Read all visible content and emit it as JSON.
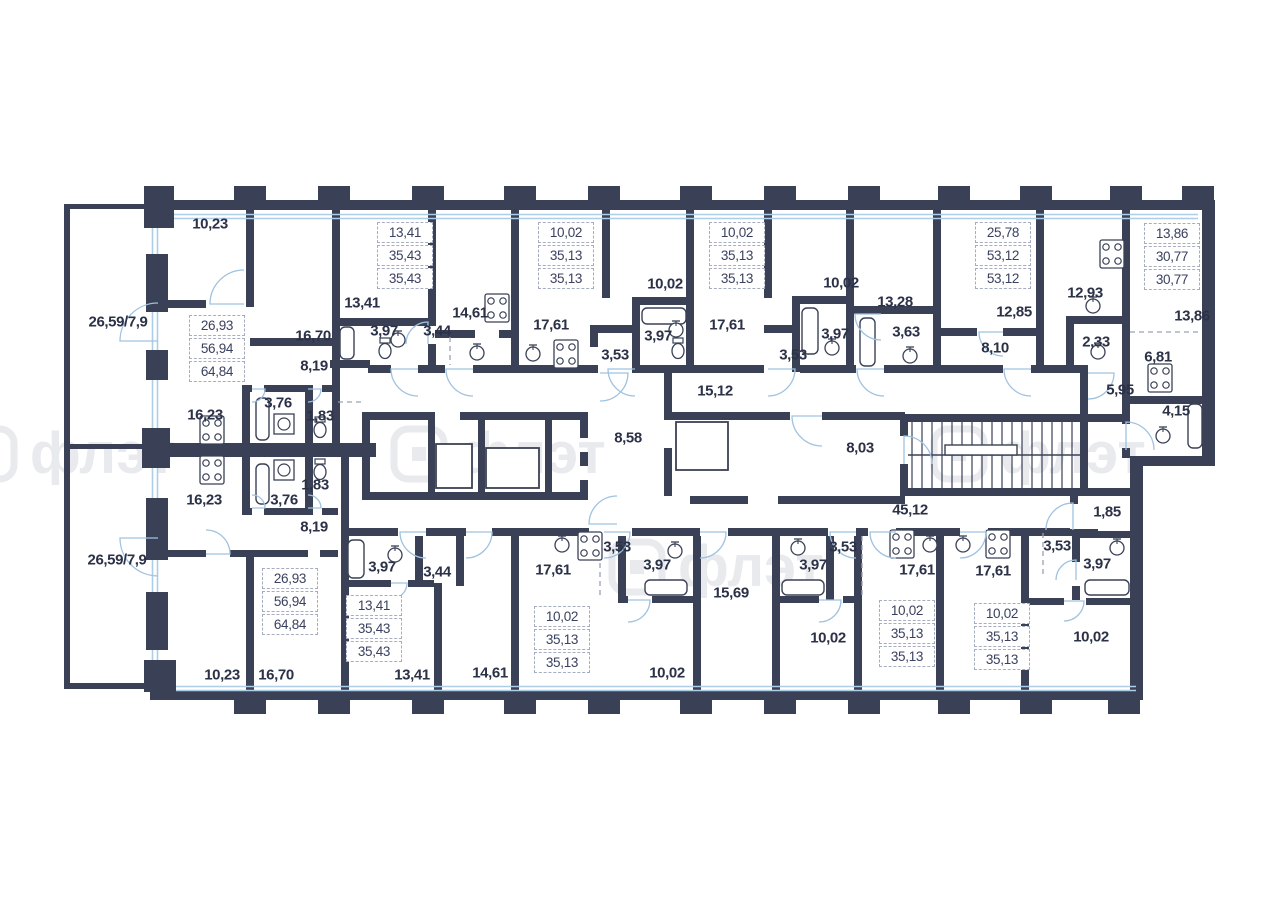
{
  "watermark": {
    "text": "флэт"
  },
  "colors": {
    "wall": "#3A4156",
    "window": "#AECDE6",
    "door": "#9FC2E0",
    "label": "#2B3147",
    "dashed": "#9BA2B6",
    "watermark": "#E9EAED",
    "boxed_border": "#A7ADC0"
  },
  "labels": [
    {
      "text": "10,23",
      "x": 210,
      "y": 224
    },
    {
      "text": "13,41",
      "x": 362,
      "y": 303
    },
    {
      "text": "3,97",
      "x": 384,
      "y": 331
    },
    {
      "text": "3,44",
      "x": 437,
      "y": 331
    },
    {
      "text": "14,61",
      "x": 470,
      "y": 313
    },
    {
      "text": "16,70",
      "x": 313,
      "y": 336
    },
    {
      "text": "8,19",
      "x": 314,
      "y": 366
    },
    {
      "text": "26,59/7,9",
      "x": 118,
      "y": 322
    },
    {
      "text": "16,23",
      "x": 205,
      "y": 415
    },
    {
      "text": "3,76",
      "x": 278,
      "y": 403
    },
    {
      "text": "1,83",
      "x": 320,
      "y": 416
    },
    {
      "text": "17,61",
      "x": 551,
      "y": 325
    },
    {
      "text": "10,02",
      "x": 665,
      "y": 284
    },
    {
      "text": "3,53",
      "x": 615,
      "y": 355
    },
    {
      "text": "3,97",
      "x": 658,
      "y": 336
    },
    {
      "text": "10,02",
      "x": 841,
      "y": 283
    },
    {
      "text": "3,53",
      "x": 793,
      "y": 355
    },
    {
      "text": "3,97",
      "x": 835,
      "y": 334
    },
    {
      "text": "17,61",
      "x": 727,
      "y": 325
    },
    {
      "text": "13,28",
      "x": 895,
      "y": 302
    },
    {
      "text": "3,63",
      "x": 906,
      "y": 332
    },
    {
      "text": "12,85",
      "x": 1014,
      "y": 312
    },
    {
      "text": "8,10",
      "x": 995,
      "y": 348
    },
    {
      "text": "12,93",
      "x": 1085,
      "y": 293
    },
    {
      "text": "2,33",
      "x": 1096,
      "y": 342
    },
    {
      "text": "13,86",
      "x": 1192,
      "y": 316
    },
    {
      "text": "6,81",
      "x": 1158,
      "y": 357
    },
    {
      "text": "5,95",
      "x": 1120,
      "y": 390
    },
    {
      "text": "4,15",
      "x": 1176,
      "y": 411
    },
    {
      "text": "15,12",
      "x": 715,
      "y": 391
    },
    {
      "text": "8,58",
      "x": 628,
      "y": 438
    },
    {
      "text": "8,03",
      "x": 860,
      "y": 448
    },
    {
      "text": "45,12",
      "x": 910,
      "y": 510
    },
    {
      "text": "1,85",
      "x": 1107,
      "y": 512
    },
    {
      "text": "26,59/7,9",
      "x": 117,
      "y": 560
    },
    {
      "text": "16,23",
      "x": 204,
      "y": 500
    },
    {
      "text": "3,76",
      "x": 284,
      "y": 500
    },
    {
      "text": "1,83",
      "x": 315,
      "y": 485
    },
    {
      "text": "8,19",
      "x": 314,
      "y": 527
    },
    {
      "text": "10,23",
      "x": 222,
      "y": 675
    },
    {
      "text": "16,70",
      "x": 276,
      "y": 675
    },
    {
      "text": "3,97",
      "x": 382,
      "y": 567
    },
    {
      "text": "3,44",
      "x": 437,
      "y": 572
    },
    {
      "text": "13,41",
      "x": 412,
      "y": 675
    },
    {
      "text": "14,61",
      "x": 490,
      "y": 673
    },
    {
      "text": "17,61",
      "x": 553,
      "y": 570
    },
    {
      "text": "3,53",
      "x": 617,
      "y": 547
    },
    {
      "text": "3,97",
      "x": 657,
      "y": 565
    },
    {
      "text": "10,02",
      "x": 667,
      "y": 673
    },
    {
      "text": "15,69",
      "x": 731,
      "y": 593
    },
    {
      "text": "3,97",
      "x": 813,
      "y": 565
    },
    {
      "text": "3,53",
      "x": 843,
      "y": 547
    },
    {
      "text": "10,02",
      "x": 828,
      "y": 638
    },
    {
      "text": "17,61",
      "x": 917,
      "y": 570
    },
    {
      "text": "17,61",
      "x": 993,
      "y": 571
    },
    {
      "text": "3,53",
      "x": 1057,
      "y": 546
    },
    {
      "text": "3,97",
      "x": 1097,
      "y": 564
    },
    {
      "text": "10,02",
      "x": 1091,
      "y": 637
    }
  ],
  "boxed_groups": [
    {
      "x": 217,
      "y": 315,
      "values": [
        "26,93",
        "56,94",
        "64,84"
      ]
    },
    {
      "x": 290,
      "y": 568,
      "values": [
        "26,93",
        "56,94",
        "64,84"
      ]
    },
    {
      "x": 405,
      "y": 222,
      "values": [
        "13,41",
        "35,43",
        "35,43"
      ]
    },
    {
      "x": 374,
      "y": 595,
      "values": [
        "13,41",
        "35,43",
        "35,43"
      ]
    },
    {
      "x": 566,
      "y": 222,
      "values": [
        "10,02",
        "35,13",
        "35,13"
      ]
    },
    {
      "x": 737,
      "y": 222,
      "values": [
        "10,02",
        "35,13",
        "35,13"
      ]
    },
    {
      "x": 562,
      "y": 606,
      "values": [
        "10,02",
        "35,13",
        "35,13"
      ]
    },
    {
      "x": 907,
      "y": 600,
      "values": [
        "10,02",
        "35,13",
        "35,13"
      ]
    },
    {
      "x": 1002,
      "y": 603,
      "values": [
        "10,02",
        "35,13",
        "35,13"
      ]
    },
    {
      "x": 1003,
      "y": 222,
      "values": [
        "25,78",
        "53,12",
        "53,12"
      ]
    },
    {
      "x": 1172,
      "y": 223,
      "values": [
        "13,86",
        "30,77",
        "30,77"
      ]
    }
  ]
}
